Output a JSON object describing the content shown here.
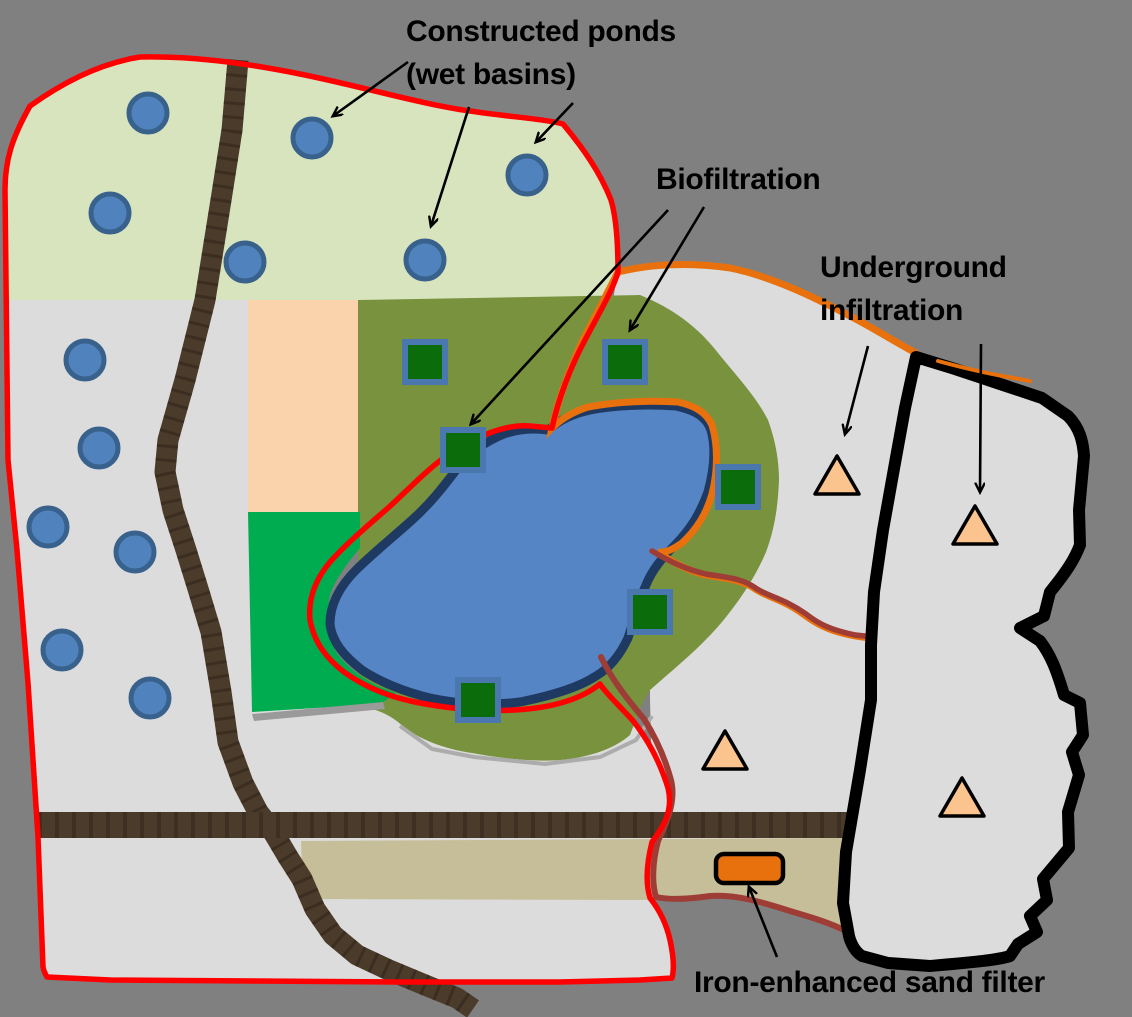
{
  "annotations": {
    "constructed_ponds": {
      "line1": "Constructed ponds",
      "line2": "(wet basins)"
    },
    "biofiltration": {
      "line1": "Biofiltration"
    },
    "underground_infiltration": {
      "line1": "Underground",
      "line2": "infiltration"
    },
    "iron_sand_filter": {
      "line1": "Iron-enhanced sand filter"
    }
  },
  "colors": {
    "background": "#808080",
    "watershed_fill": "#DCDCDC",
    "upland_green": "#D8E4BE",
    "olive_zone": "#78923E",
    "bright_green_parcel": "#00AC50",
    "peach_parcel": "#FAD2AC",
    "tan_band": "#C6BE98",
    "lake_fill": "#5585C4",
    "lake_border": "#1E3A63",
    "road_brown": "#4B3B2A",
    "watershed_boundary_red": "#FF0000",
    "subwatershed_boundary_orange": "#E8710D",
    "stream_maroon": "#9E3C36",
    "black_region_border": "#000000",
    "pond_fill": "#5083BE",
    "pond_border": "#38618C",
    "biofilter_fill": "#0A6C0A",
    "biofilter_border": "#4A77AE",
    "infiltration_fill": "#FBC38D",
    "infiltration_border": "#000000",
    "sand_filter_fill": "#E8710D",
    "shadow_gray": "#9A9A9A"
  },
  "features": {
    "ponds": [
      [
        148,
        113
      ],
      [
        312,
        138
      ],
      [
        527,
        175
      ],
      [
        110,
        213
      ],
      [
        245,
        262
      ],
      [
        425,
        260
      ],
      [
        85,
        360
      ],
      [
        99,
        448
      ],
      [
        48,
        527
      ],
      [
        135,
        552
      ],
      [
        62,
        650
      ],
      [
        150,
        698
      ]
    ],
    "pond_radius": 19,
    "biofiltration_cells": [
      [
        425,
        362
      ],
      [
        625,
        362
      ],
      [
        463,
        450
      ],
      [
        738,
        487
      ],
      [
        650,
        612
      ],
      [
        478,
        700
      ]
    ],
    "biofiltration_cell_size": 40,
    "underground_infiltration_sites": [
      [
        837,
        477
      ],
      [
        975,
        527
      ],
      [
        725,
        752
      ],
      [
        962,
        799
      ]
    ],
    "iron_enhanced_sand_filter": {
      "x": 716,
      "y": 854,
      "w": 67,
      "h": 29
    },
    "annotation_arrows": [
      [
        [
          408,
          62
        ],
        [
          333,
          116
        ]
      ],
      [
        [
          469,
          107
        ],
        [
          431,
          226
        ]
      ],
      [
        [
          573,
          103
        ],
        [
          536,
          142
        ]
      ],
      [
        [
          668,
          210
        ],
        [
          471,
          424
        ]
      ],
      [
        [
          704,
          207
        ],
        [
          630,
          330
        ]
      ],
      [
        [
          868,
          346
        ],
        [
          845,
          434
        ]
      ],
      [
        [
          981,
          344
        ],
        [
          980,
          492
        ]
      ],
      [
        [
          777,
          957
        ],
        [
          749,
          887
        ]
      ]
    ]
  }
}
